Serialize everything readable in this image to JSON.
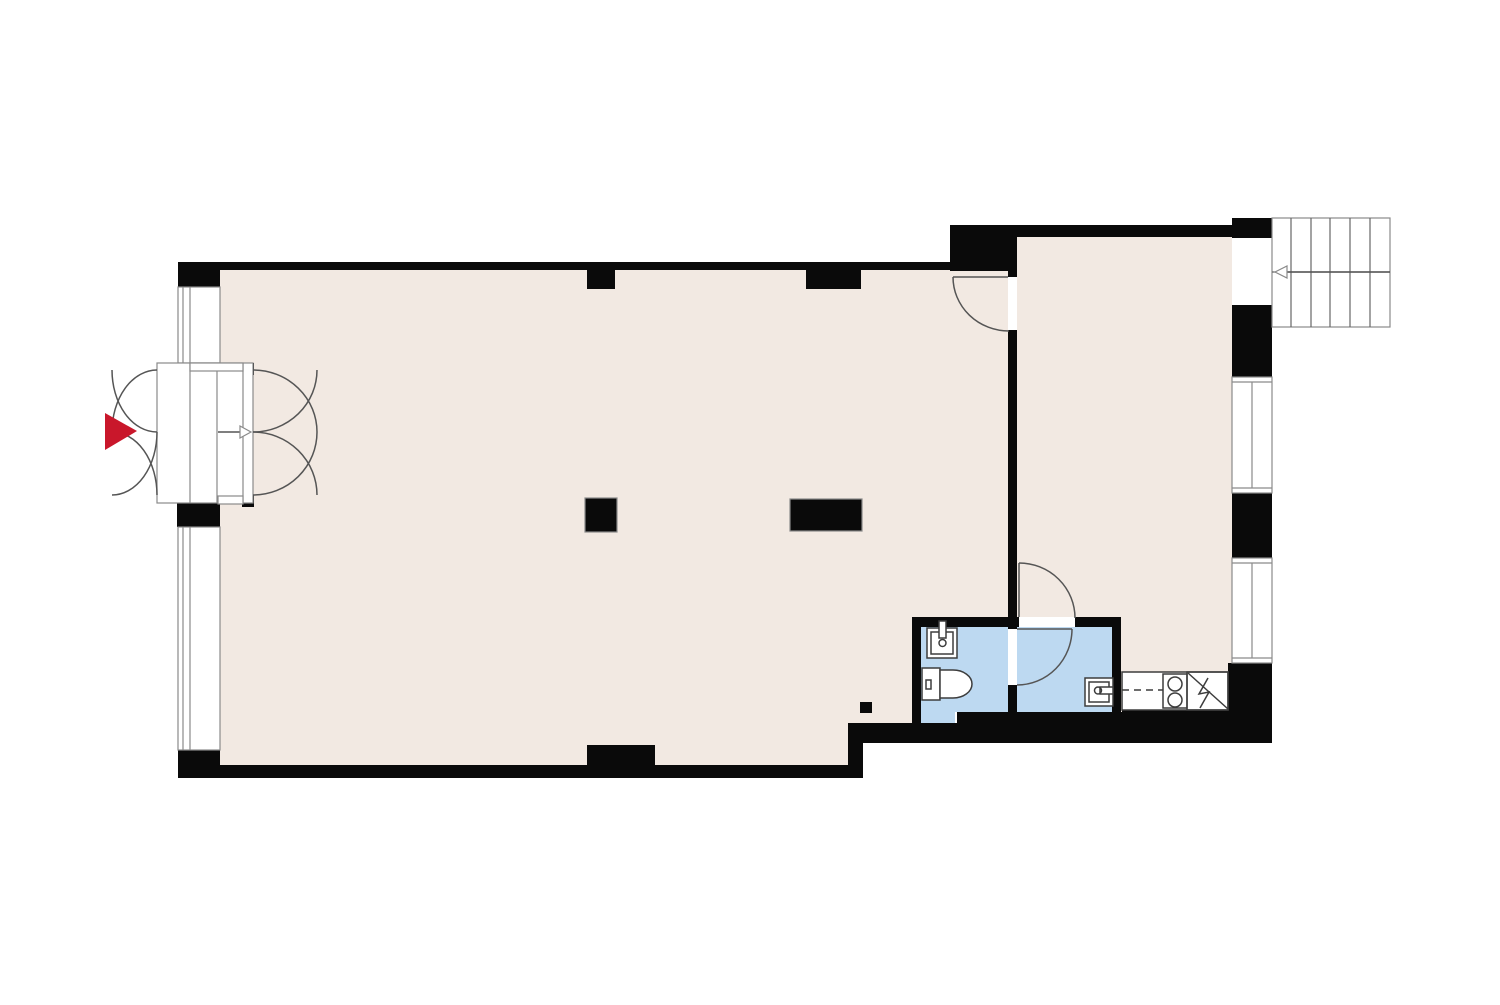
{
  "floor_plan": {
    "kind": "architectural-floor-plan",
    "colors": {
      "background": "#ffffff",
      "wall": "#0a0a0a",
      "floor": "#f2e9e2",
      "wet_area": "#bdd9f1",
      "outline": "#555555",
      "frame": "#8a8a8a",
      "fixture": "#3d3d3d",
      "stair_line": "#666666",
      "accent_red": "#c9172b"
    },
    "rooms": [
      {
        "name": "main-room",
        "finish": "floor"
      },
      {
        "name": "second-room",
        "finish": "floor"
      },
      {
        "name": "toilet-room",
        "finish": "wet_area"
      },
      {
        "name": "washroom",
        "finish": "wet_area"
      }
    ],
    "fixtures": [
      "entrance-double-doors",
      "entry-direction-arrow",
      "entrance-marker-red-arrow",
      "storefront-windows",
      "hand-basin",
      "toilet",
      "utility-sink",
      "kitchen-counter",
      "two-burner-stove",
      "refrigerator",
      "staircase",
      "stair-direction-arrow",
      "side-windows",
      "structural-columns"
    ]
  }
}
